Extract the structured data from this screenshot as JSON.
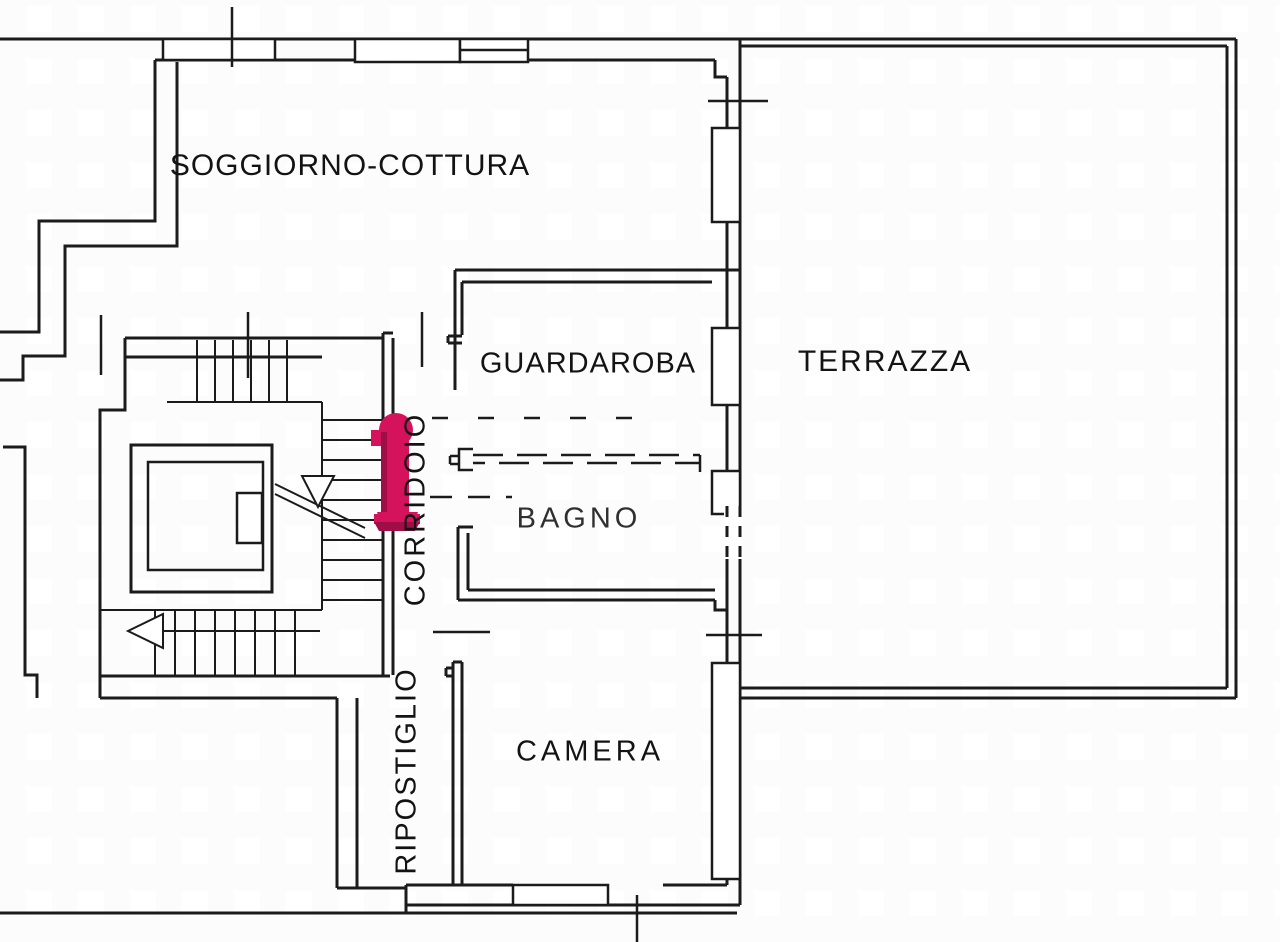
{
  "plan": {
    "title": "Piantina appartamento",
    "type": "floor-plan",
    "language": "Italian",
    "rooms": [
      {
        "id": "soggiorno-cottura",
        "label": "SOGGIORNO-COTTURA",
        "orientation": "horizontal"
      },
      {
        "id": "guardaroba",
        "label": "GUARDAROBA",
        "orientation": "horizontal"
      },
      {
        "id": "terrazza",
        "label": "TERRAZZA",
        "orientation": "horizontal"
      },
      {
        "id": "bagno",
        "label": "BAGNO",
        "orientation": "horizontal"
      },
      {
        "id": "corridoio",
        "label": "CORRIDOIO",
        "orientation": "vertical"
      },
      {
        "id": "ripostiglio",
        "label": "RIPOSTIGLIO",
        "orientation": "vertical"
      },
      {
        "id": "camera",
        "label": "CAMERA",
        "orientation": "horizontal"
      }
    ],
    "marker": {
      "id": "entrance-marker",
      "color": "#D5135C",
      "shade_color": "#A00E47",
      "meaning": "highlighted entrance position"
    },
    "symbols": [
      "staircase",
      "elevator",
      "stair-arrow-down",
      "stair-arrow-left",
      "window",
      "door-opening",
      "dashed-projection-line"
    ],
    "colors": {
      "wall": "#1b1b1b",
      "background": "#ffffff"
    }
  }
}
